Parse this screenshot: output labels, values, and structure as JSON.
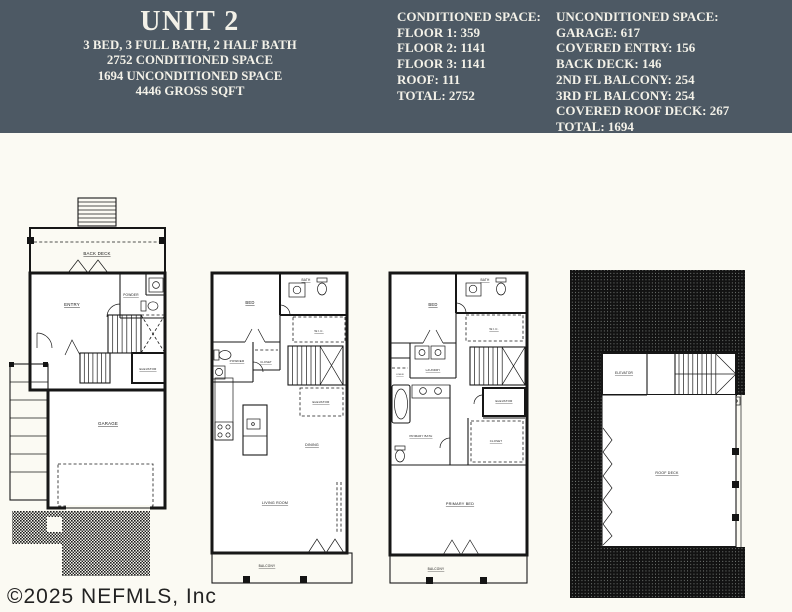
{
  "colors": {
    "header_bg": "#4d5964",
    "header_text": "#f3f1e8",
    "page_bg": "#fbfaf3",
    "plan_line": "#161616"
  },
  "header": {
    "title": "UNIT 2",
    "subtitle_lines": [
      "3 BED, 3 FULL BATH, 2 HALF BATH",
      "2752 CONDITIONED SPACE",
      "1694 UNCONDITIONED SPACE",
      "4446 GROSS SQFT"
    ],
    "conditioned": {
      "heading": "CONDITIONED SPACE:",
      "lines": [
        "FLOOR 1: 359",
        "FLOOR 2: 1141",
        "FLOOR 3: 1141",
        "ROOF: 111",
        "TOTAL: 2752"
      ]
    },
    "unconditioned": {
      "heading": "UNCONDITIONED SPACE:",
      "lines": [
        "GARAGE: 617",
        "COVERED ENTRY: 156",
        "BACK DECK: 146",
        "2ND FL BALCONY: 254",
        "3RD FL BALCONY: 254",
        "COVERED ROOF DECK: 267",
        "TOTAL: 1694"
      ]
    }
  },
  "watermark": "©2025 NEFMLS, Inc",
  "plans": {
    "floor1": {
      "back_deck": "BACK DECK",
      "entry": "ENTRY",
      "powder": "POWDER",
      "elevator": "ELEVATOR",
      "garage": "GARAGE"
    },
    "floor2": {
      "bed": "BED",
      "bath": "BATH",
      "wic": "W.I.C.",
      "powder": "POWDER",
      "closet": "CLOSET",
      "elevator": "ELEVATOR",
      "dining": "DINING",
      "living": "LIVING ROOM",
      "balcony": "BALCONY"
    },
    "floor3": {
      "bed": "BED",
      "bath": "BATH",
      "wic": "W.I.C.",
      "laundry": "LAUNDRY",
      "linen": "LINEN",
      "elevator": "ELEVATOR",
      "primary_bath": "PRIMARY BATH",
      "closet": "CLOSET",
      "primary_bed": "PRIMARY BED",
      "balcony": "BALCONY"
    },
    "roof": {
      "elevator": "ELEVATOR",
      "roof_deck": "ROOF DECK"
    }
  }
}
